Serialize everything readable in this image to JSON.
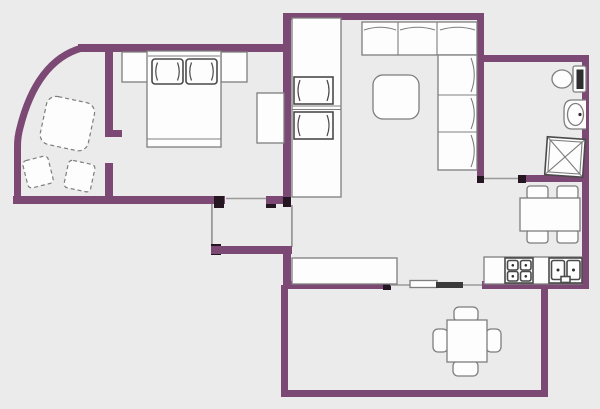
{
  "page": {
    "title": "apartment-floor-plan"
  },
  "colors": {
    "bg": "#ebebeb",
    "wall": "#7c4874",
    "wall_dark": "#241721",
    "threshold": "#9a9a9a",
    "furniture_fill": "#fdfdfd",
    "furniture_stroke": "#7e7e7e",
    "furniture_stroke_dark": "#4a4a4a",
    "door_leaf": "#3a3a3a",
    "fixture_dark": "#2e2e2e"
  },
  "rooms": {
    "balcony": {
      "furniture": [
        "round-corner-table-dashed",
        "chair-dashed",
        "chair-dashed"
      ]
    },
    "bedroom": {
      "furniture": [
        "double-bed",
        "pillow",
        "pillow",
        "nightstand",
        "nightstand",
        "dresser"
      ]
    },
    "living_room": {
      "furniture": [
        "wardrobe-column",
        "armchair",
        "armchair",
        "corner-sofa",
        "coffee-table",
        "sideboard-counter"
      ]
    },
    "entry_vestibule": {
      "furniture": []
    },
    "bathroom": {
      "furniture": [
        "toilet",
        "washbasin",
        "shower-cabin"
      ]
    },
    "kitchen": {
      "furniture": [
        "dining-table",
        "chair",
        "chair",
        "chair",
        "chair",
        "kitchen-counter",
        "stove-4-burners",
        "double-sink"
      ]
    },
    "patio": {
      "furniture": [
        "square-table",
        "chair",
        "chair",
        "chair",
        "chair"
      ]
    }
  }
}
